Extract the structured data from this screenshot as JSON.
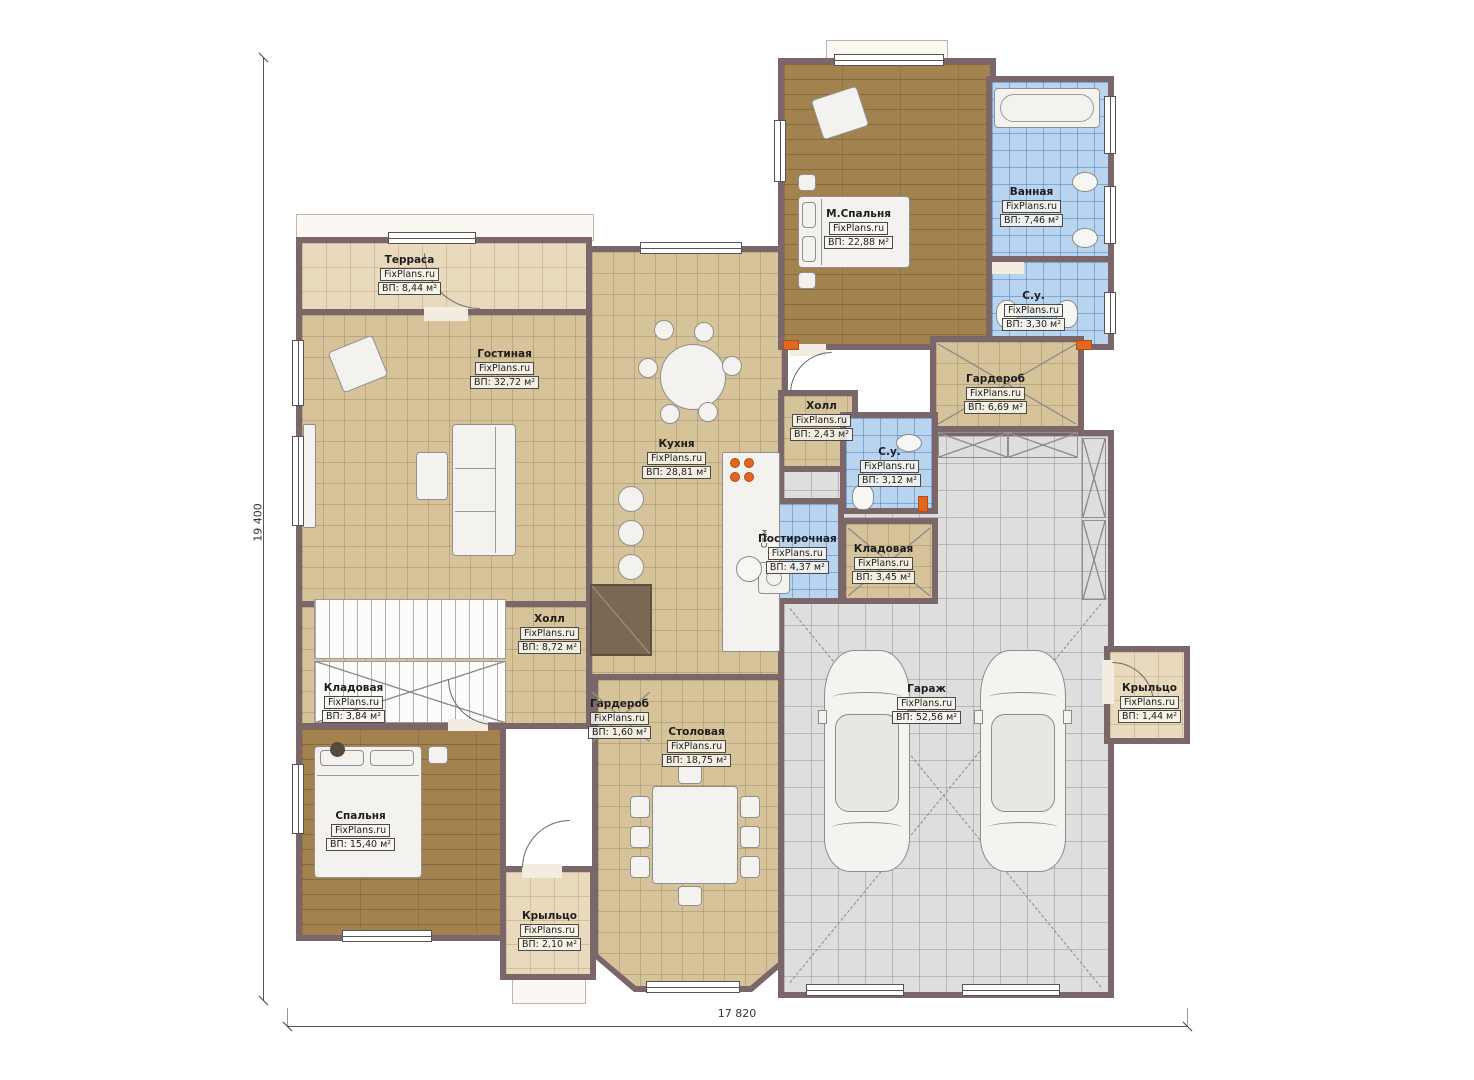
{
  "brand": "FixPlans.ru",
  "dimensions": {
    "height_label": "19 400",
    "width_label": "17 820"
  },
  "labels": {
    "washer": "Ст.м"
  },
  "rooms": [
    {
      "name": "Терраса",
      "area": "ВП: 8,44 м²"
    },
    {
      "name": "Гостиная",
      "area": "ВП: 32,72 м²"
    },
    {
      "name": "М.Спальня",
      "area": "ВП: 22,88 м²"
    },
    {
      "name": "Ванная",
      "area": "ВП: 7,46 м²"
    },
    {
      "name": "С.у.",
      "area": "ВП: 3,30 м²"
    },
    {
      "name": "Гардероб",
      "area": "ВП: 6,69 м²"
    },
    {
      "name": "Холл",
      "area": "ВП: 2,43 м²"
    },
    {
      "name": "С.у.",
      "area": "ВП: 3,12 м²"
    },
    {
      "name": "Кухня",
      "area": "ВП: 28,81 м²"
    },
    {
      "name": "Постирочная",
      "area": "ВП: 4,37 м²"
    },
    {
      "name": "Кладовая",
      "area": "ВП: 3,45 м²"
    },
    {
      "name": "Холл",
      "area": "ВП: 8,72 м²"
    },
    {
      "name": "Кладовая",
      "area": "ВП: 3,84 м²"
    },
    {
      "name": "Гардероб",
      "area": "ВП: 1,60 м²"
    },
    {
      "name": "Столовая",
      "area": "ВП: 18,75 м²"
    },
    {
      "name": "Гараж",
      "area": "ВП: 52,56 м²"
    },
    {
      "name": "Спальня",
      "area": "ВП: 15,40 м²"
    },
    {
      "name": "Крыльцо",
      "area": "ВП: 2,10 м²"
    },
    {
      "name": "Крыльцо",
      "area": "ВП: 1,44 м²"
    }
  ]
}
